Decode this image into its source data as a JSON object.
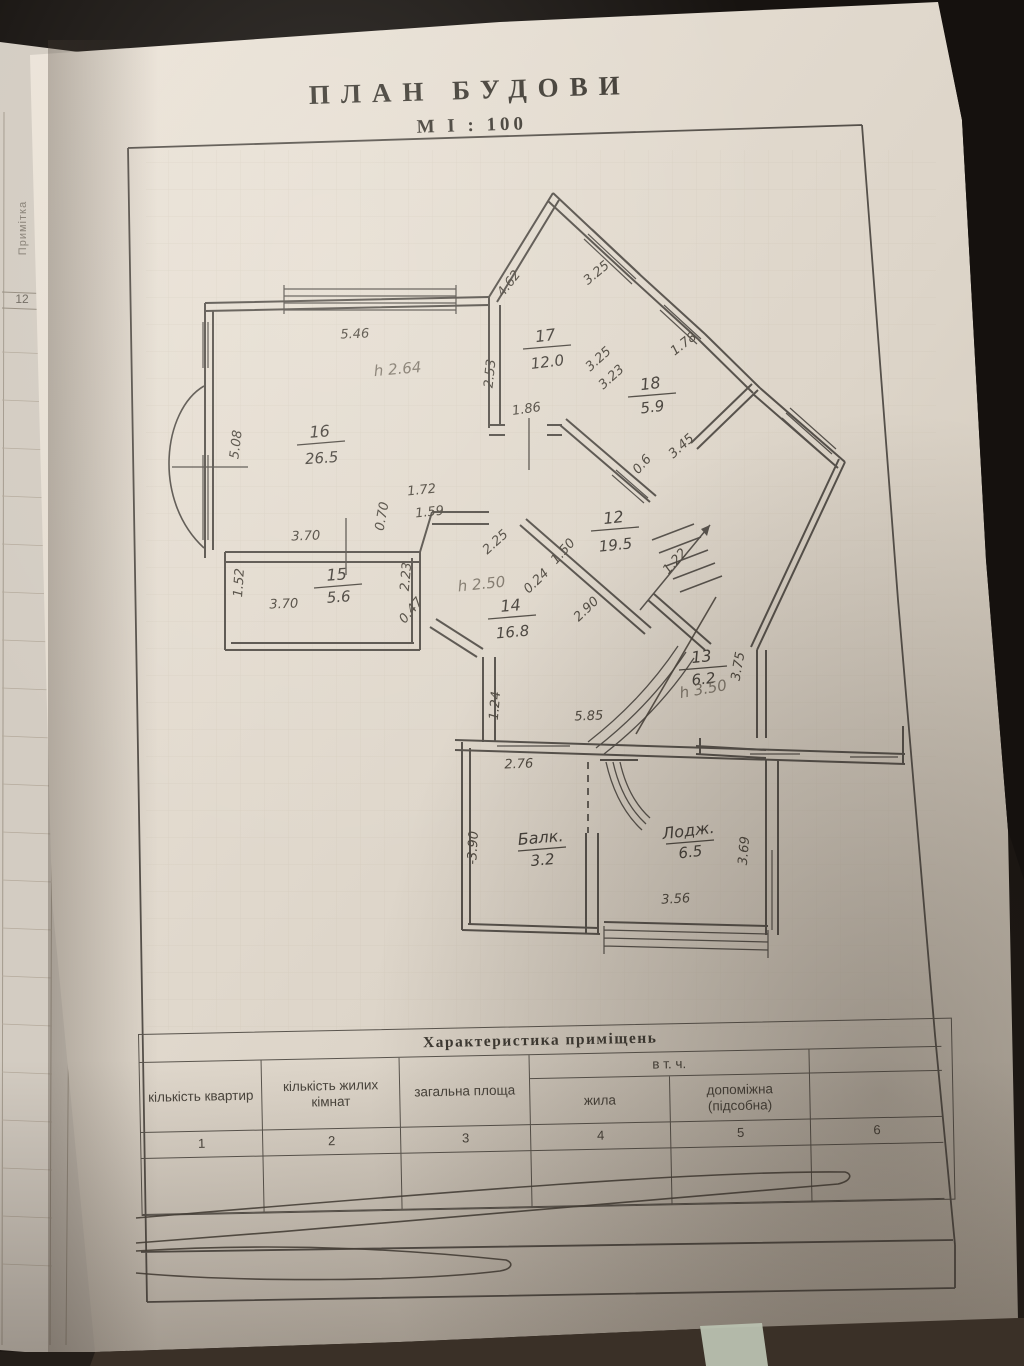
{
  "photo": {
    "paper_color": "#e3dbcf",
    "underpage_color": "#d3ccc2",
    "line_color": "#55504a",
    "pencil_color": "#6b6357",
    "background_color": "#15110e",
    "floor_color": "#3a3027",
    "green_stripe_color": "#b9c1b0"
  },
  "title": {
    "main": "ПЛАН  БУДОВИ",
    "scale": "М І : 100"
  },
  "left_margin": {
    "note_column_label": "Примітка",
    "row_number": "12",
    "small_text_line1": "перевір. запис",
    "small_text_line2": "і площ. (кв.м)"
  },
  "plan": {
    "rooms": [
      {
        "label": "16",
        "area": "26.5",
        "x": 320,
        "y": 437,
        "rot": -4,
        "dy": 26
      },
      {
        "label": "15",
        "area": "5.6",
        "x": 337,
        "y": 580,
        "rot": -4,
        "dy": 22
      },
      {
        "label": "17",
        "area": "12.0",
        "x": 546,
        "y": 341,
        "rot": -7,
        "dy": 26
      },
      {
        "label": "18",
        "area": "5.9",
        "x": 651,
        "y": 389,
        "rot": -7,
        "dy": 23
      },
      {
        "label": "12",
        "area": "19.5",
        "x": 614,
        "y": 523,
        "rot": -6,
        "dy": 27
      },
      {
        "label": "14",
        "area": "16.8",
        "x": 511,
        "y": 611,
        "rot": -5,
        "dy": 26
      },
      {
        "label": "13",
        "area": "6.2",
        "x": 702,
        "y": 662,
        "rot": -6,
        "dy": 22
      },
      {
        "label": "Балк.",
        "area": "3.2",
        "x": 541,
        "y": 843,
        "rot": -5,
        "dy": 22
      },
      {
        "label": "Лодж.",
        "area": "6.5",
        "x": 689,
        "y": 836,
        "rot": -7,
        "dy": 21
      }
    ],
    "height_marks": [
      {
        "text": "h 2.64",
        "x": 398,
        "y": 374,
        "rot": -5
      },
      {
        "text": "h 2.50",
        "x": 482,
        "y": 589,
        "rot": -6
      },
      {
        "text": "h 3.50",
        "x": 704,
        "y": 694,
        "rot": -10
      }
    ],
    "dimensions": [
      {
        "text": "5.46",
        "x": 355,
        "y": 338,
        "rot": -2
      },
      {
        "text": "5.08",
        "x": 240,
        "y": 445,
        "rot": -83
      },
      {
        "text": "3.70",
        "x": 306,
        "y": 540,
        "rot": -2
      },
      {
        "text": "1.52",
        "x": 243,
        "y": 583,
        "rot": -86
      },
      {
        "text": "3.70",
        "x": 284,
        "y": 608,
        "rot": -2
      },
      {
        "text": "2.23",
        "x": 410,
        "y": 577,
        "rot": -85
      },
      {
        "text": "0.47",
        "x": 414,
        "y": 613,
        "rot": -50
      },
      {
        "text": "0.70",
        "x": 386,
        "y": 517,
        "rot": -80
      },
      {
        "text": "1.72",
        "x": 422,
        "y": 494,
        "rot": -6
      },
      {
        "text": "1.59",
        "x": 430,
        "y": 516,
        "rot": -6
      },
      {
        "text": "2.53",
        "x": 494,
        "y": 374,
        "rot": -84
      },
      {
        "text": "1.86",
        "x": 527,
        "y": 413,
        "rot": -8
      },
      {
        "text": "4.62",
        "x": 512,
        "y": 286,
        "rot": -52
      },
      {
        "text": "3.25",
        "x": 599,
        "y": 276,
        "rot": -40
      },
      {
        "text": "3.25",
        "x": 601,
        "y": 362,
        "rot": -42
      },
      {
        "text": "3.23",
        "x": 614,
        "y": 380,
        "rot": -42
      },
      {
        "text": "1.78",
        "x": 686,
        "y": 347,
        "rot": -38
      },
      {
        "text": "3.45",
        "x": 684,
        "y": 449,
        "rot": -42
      },
      {
        "text": "0.6",
        "x": 645,
        "y": 467,
        "rot": -48
      },
      {
        "text": "2.25",
        "x": 498,
        "y": 545,
        "rot": -42
      },
      {
        "text": "1.50",
        "x": 566,
        "y": 554,
        "rot": -48
      },
      {
        "text": "0.24",
        "x": 539,
        "y": 584,
        "rot": -44
      },
      {
        "text": "2.90",
        "x": 589,
        "y": 612,
        "rot": -44
      },
      {
        "text": "1.22",
        "x": 678,
        "y": 564,
        "rot": -48
      },
      {
        "text": "3.75",
        "x": 742,
        "y": 667,
        "rot": -80
      },
      {
        "text": "5.85",
        "x": 589,
        "y": 720,
        "rot": -2
      },
      {
        "text": "1.24",
        "x": 499,
        "y": 706,
        "rot": -85
      },
      {
        "text": "2.76",
        "x": 519,
        "y": 768,
        "rot": -2
      },
      {
        "text": "-3.90",
        "x": 477,
        "y": 848,
        "rot": -87
      },
      {
        "text": "3.69",
        "x": 748,
        "y": 851,
        "rot": -85
      },
      {
        "text": "3.56",
        "x": 676,
        "y": 903,
        "rot": -3
      }
    ]
  },
  "table": {
    "title": "Характеристика  приміщень",
    "group_header": "в т. ч.",
    "columns": [
      {
        "label": "кількість квартир",
        "number": "1"
      },
      {
        "label": "кількість жилих кімнат",
        "number": "2"
      },
      {
        "label": "загальна площа",
        "number": "3"
      },
      {
        "label": "жила",
        "number": "4"
      },
      {
        "label": "допоміжна (підсобна)",
        "number": "5"
      },
      {
        "label": "",
        "number": "6"
      }
    ]
  }
}
